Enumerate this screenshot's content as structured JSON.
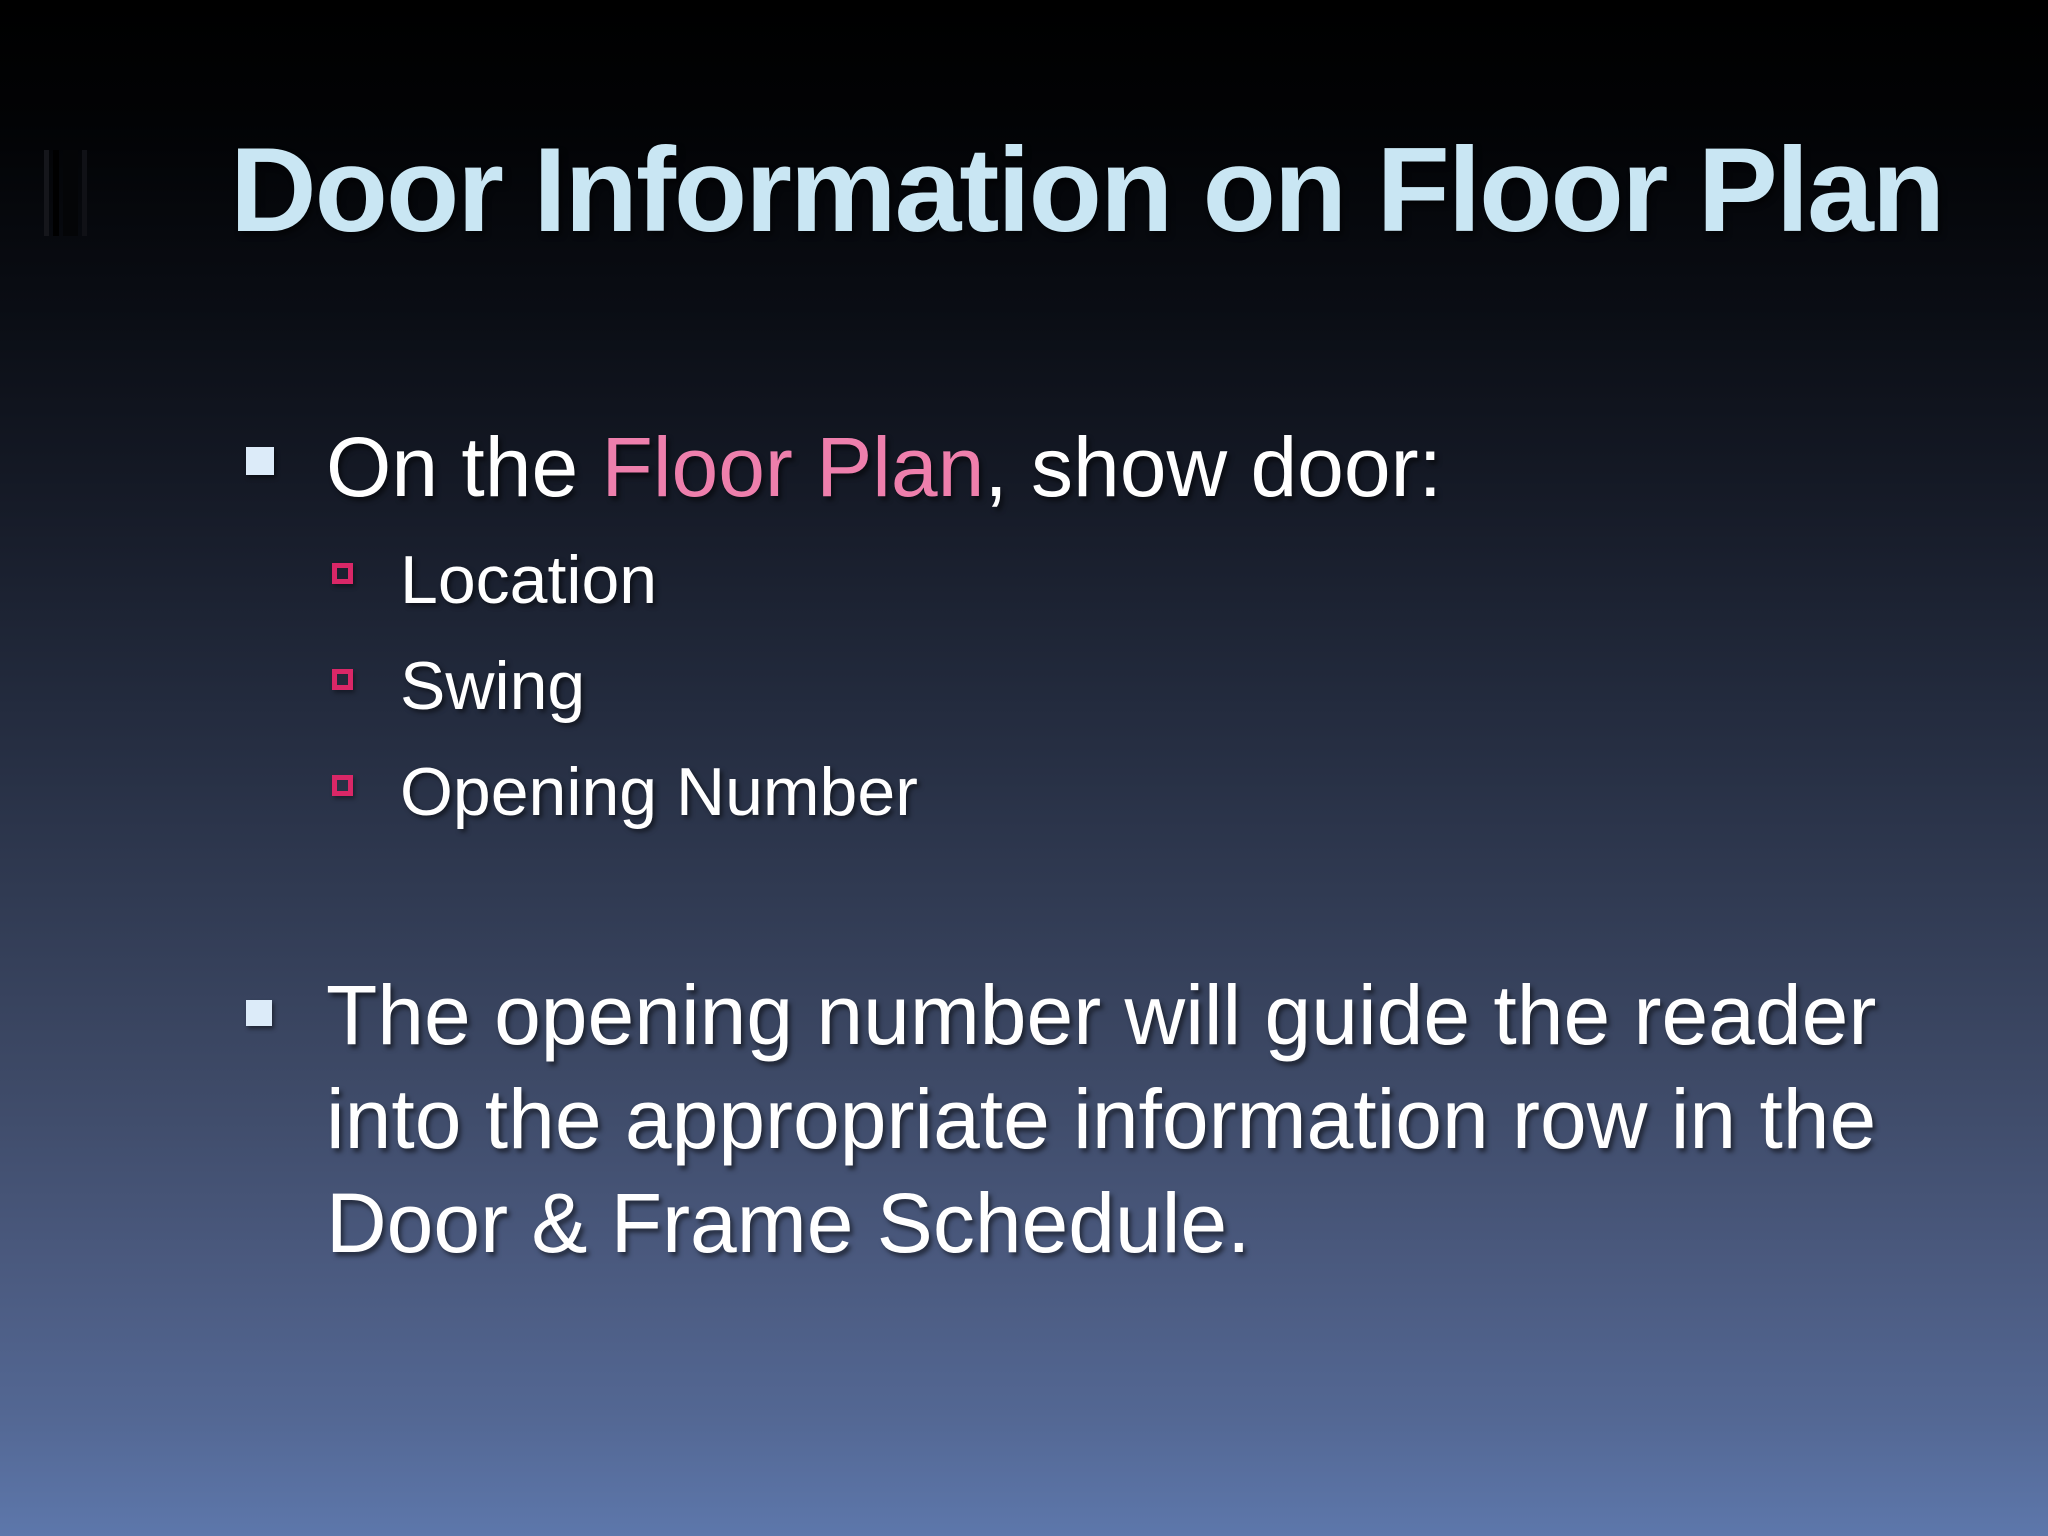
{
  "slide": {
    "title": "Door Information on Floor Plan",
    "bullet1": {
      "prefix": "On the ",
      "highlight": "Floor Plan",
      "suffix": ", show door:"
    },
    "sub_items": [
      "Location",
      "Swing",
      "Opening Number"
    ],
    "bullet2_lines": [
      "The opening number will guide the reader",
      "into the appropriate information row in the",
      "Door & Frame Schedule."
    ],
    "icons": {
      "decorative_bars": "vertical-bars-icon",
      "bullet_marker": "filled-square-icon",
      "sub_bullet_marker": "hollow-square-icon"
    },
    "colors": {
      "title_text": "#c9e6f3",
      "body_text": "#ffffff",
      "highlight_pink": "#ee7fac",
      "bullet_square": "#dcebf9",
      "sub_bullet_outline": "#d92767",
      "background_top": "#000000",
      "background_bottom": "#5d77ab"
    }
  }
}
